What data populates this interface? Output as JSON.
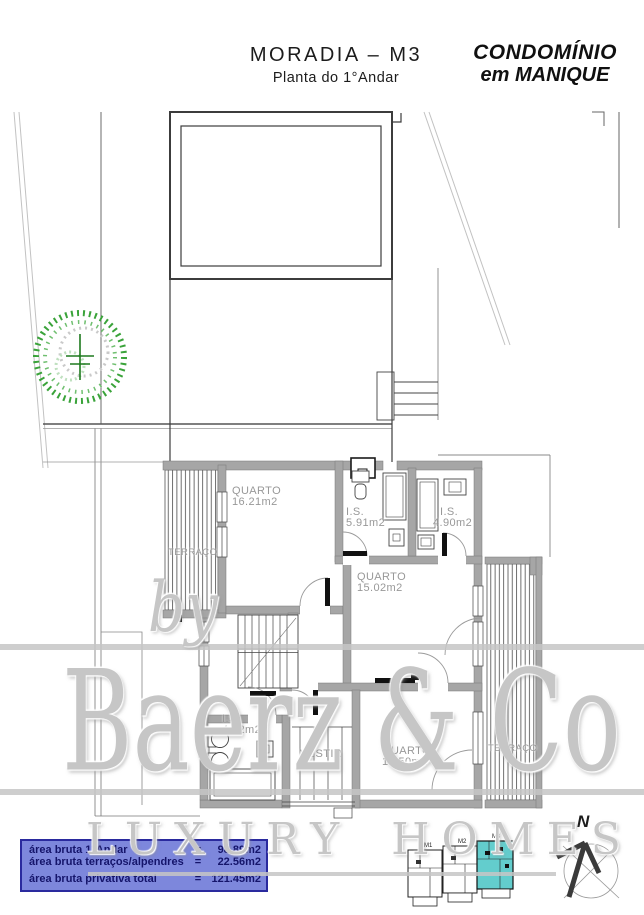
{
  "header": {
    "title": "MORADIA – M3",
    "subtitle": "Planta do 1°Andar",
    "brand_line1": "CONDOMÍNIO",
    "brand_line2": "em MANIQUE"
  },
  "plan": {
    "rooms": {
      "quarto1": {
        "name": "QUARTO",
        "area": "16.21m2"
      },
      "is1": {
        "name": "I.S.",
        "area": "5.91m2"
      },
      "is2": {
        "name": "I.S.",
        "area": "4.90m2"
      },
      "quarto2": {
        "name": "QUARTO",
        "area": "15.02m2"
      },
      "is3": {
        "name": "I.S.",
        "area": "4.62m2"
      },
      "vestir": {
        "name": "VESTIR"
      },
      "quarto3": {
        "name": "QUARTO",
        "area": "13.50m2"
      },
      "terraco_left": {
        "name": "TERRAÇO"
      },
      "terraco_right": {
        "name": "TERRAÇO"
      }
    }
  },
  "legend": {
    "rows": [
      {
        "label": "área bruta 1°Andar",
        "eq": "=",
        "value": "98.89m2"
      },
      {
        "label": "área bruta terraços/alpendres",
        "eq": "=",
        "value": "22.56m2"
      },
      {
        "label": "área bruta privativa total",
        "eq": "=",
        "value": "121.45m2"
      }
    ]
  },
  "keyplan": {
    "units": [
      "M1",
      "M2",
      "M3"
    ],
    "highlighted_unit": "M3",
    "highlight_color": "#63cdcd",
    "north_label": "N"
  },
  "watermark": {
    "by": "by",
    "name": "Baerz & Co",
    "tagline": "LUXURY HOMES"
  },
  "colors": {
    "legend_bg": "#7d87dc",
    "legend_border": "#2a2a9e",
    "legend_text": "#15156b",
    "wall_gray": "#a6a6a6",
    "tree_green": "#3aa33a"
  }
}
